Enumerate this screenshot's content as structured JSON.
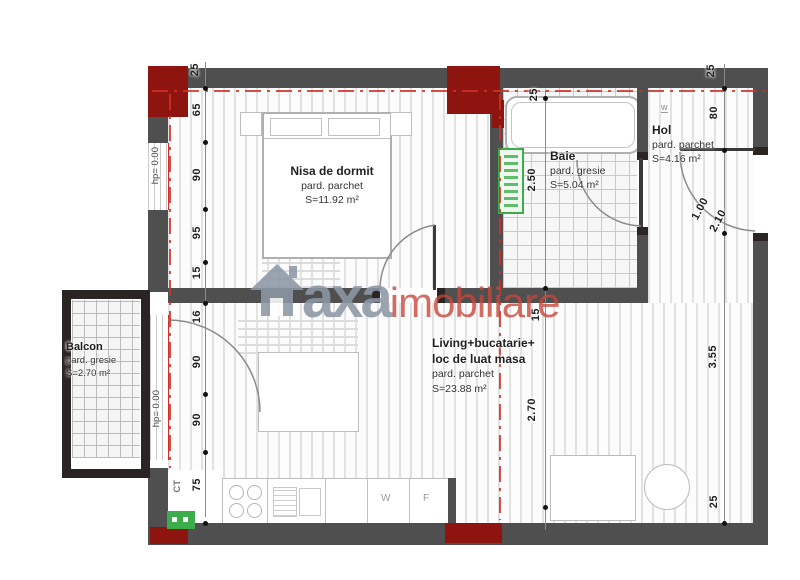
{
  "plan_title": "Apartment floor plan",
  "rooms": {
    "bedroom": {
      "name": "Nisa de dormit",
      "floor": "pard. parchet",
      "area": "S=11.92 m²"
    },
    "bathroom": {
      "name": "Baie",
      "floor": "pard. gresie",
      "area": "S=5.04 m²"
    },
    "hall": {
      "name": "Hol",
      "floor": "pard. parchet",
      "area": "S=4.16 m²"
    },
    "balcony": {
      "name": "Balcon",
      "floor": "pard. gresie",
      "area": "S=2.70 m²"
    },
    "living": {
      "name": "Living+bucatarie+",
      "name2": "loc de luat masa",
      "floor": "pard. parchet",
      "area": "S=23.88 m²"
    }
  },
  "dims": {
    "left": [
      "25",
      "65",
      "90",
      "95",
      "15",
      "16",
      "90",
      "90",
      "75"
    ],
    "mid": [
      "25",
      "2.50",
      "15",
      "2.70"
    ],
    "right": [
      "25",
      "80",
      "1.00",
      "2.10",
      "3.55",
      "25"
    ]
  },
  "annotations": {
    "level_window": "hp= 0.00",
    "level_balcony_door": "hp= 0.00",
    "boiler": "CT",
    "washer": "W",
    "fridge": "F",
    "hall_window_mark": "w"
  },
  "watermark": {
    "brand": "axa",
    "suffix": "imobiliare"
  },
  "colors": {
    "wall": "#4f4f4f",
    "wall-dark": "#2a2522",
    "column-red": "#8e1410",
    "axis-red": "#d03026",
    "green-marker": "#3bae4b",
    "text": "#1f1f1f",
    "watermark-gray": "#8d97a6",
    "watermark-red": "#c8453a",
    "floor-line": "#e2e2e2",
    "tile-line": "#c9c9c9"
  }
}
